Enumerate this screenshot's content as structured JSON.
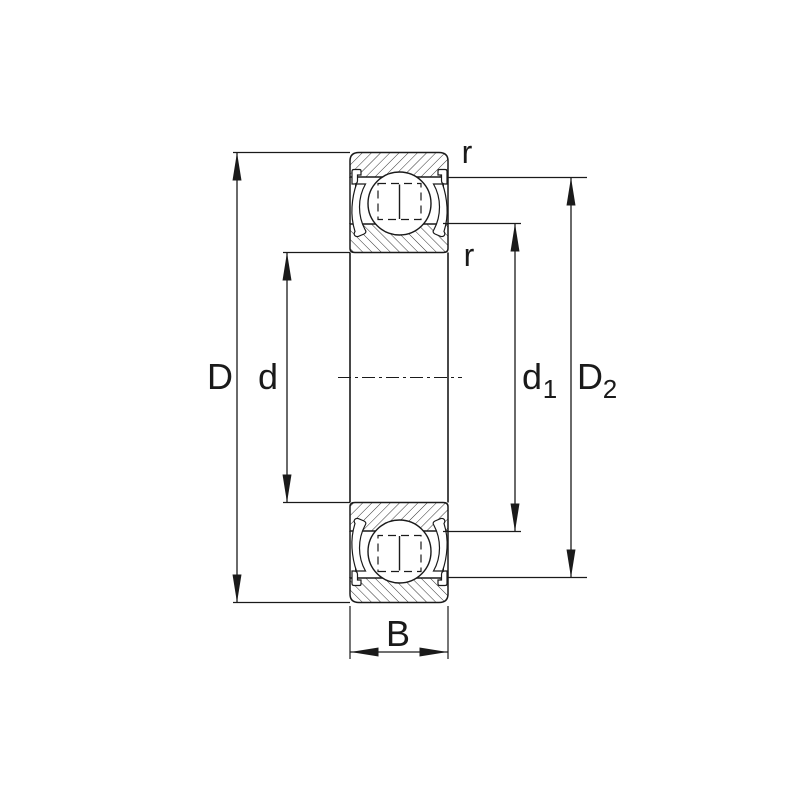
{
  "diagram": {
    "type": "bearing-cross-section-dimension-drawing",
    "part": "deep-groove ball bearing, shielded (2Z), side view cross-section",
    "labels": {
      "outer_diameter": "D",
      "bore_diameter": "d",
      "inner_shoulder_base": "d",
      "inner_shoulder_sub": "1",
      "outer_shoulder_base": "D",
      "outer_shoulder_sub": "2",
      "width": "B",
      "radius_outer": "r",
      "radius_inner": "r"
    },
    "colors": {
      "line": "#1a1a1a",
      "background": "#ffffff"
    }
  }
}
